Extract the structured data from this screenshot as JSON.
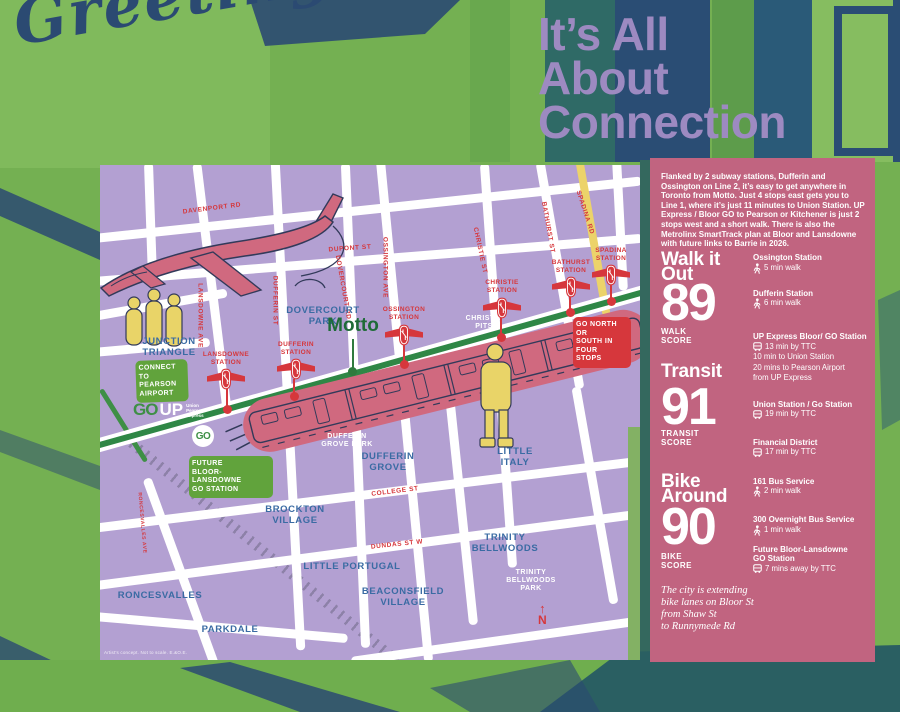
{
  "background": {
    "graffiti_text": "Greetings",
    "colors": {
      "bg_green": "#74b052",
      "navy": "#2b4a72",
      "teal": "#2f6a66",
      "map_purple": "#b3a0d2",
      "panel_pink": "#c16480",
      "station_red": "#d6373c",
      "line_green": "#2f8746",
      "badge_green": "#61a33c",
      "accent_yellow": "#ecd36a",
      "label_blue": "#3a6ba3",
      "title_purple": "#9d8ac1"
    }
  },
  "title": {
    "text": "It’s All\nAbout\nConnection"
  },
  "sidebar": {
    "intro": "Flanked by 2 subway stations, Dufferin and Ossington on Line 2, it’s easy to get anywhere in Toronto from Motto. Just 4 stops east gets you to Line 1, where it’s just 11 minutes to Union Station. UP Express / Bloor GO to Pearson or Kitchener is just 2 stops west and a short walk. There is also the Metrolinx SmartTrack plan at Bloor and Lansdowne with future links to Barrie in 2026.",
    "scores": [
      {
        "heading": "Walk it\nOut",
        "value": "89",
        "label": "WALK\nSCORE"
      },
      {
        "heading": "Transit",
        "value": "91",
        "label": "TRANSIT\nSCORE"
      },
      {
        "heading": "Bike\nAround",
        "value": "90",
        "label": "BIKE\nSCORE"
      }
    ],
    "note": "The city is extending\nbike lanes on Bloor St\nfrom Shaw St\nto Runnymede Rd",
    "destinations": [
      {
        "name": "Ossington Station",
        "icon": "walk",
        "lines": [
          "5 min walk"
        ]
      },
      {
        "name": "Dufferin Station",
        "icon": "walk",
        "lines": [
          "6 min walk"
        ]
      },
      {
        "name": "UP Express Bloor/ GO Station",
        "icon": "bus",
        "lines": [
          "13 min by TTC",
          "10 min to Union Station",
          "20 mins to Pearson Airport",
          "from UP Express"
        ]
      },
      {
        "name": "Union Station / Go Station",
        "icon": "bus",
        "lines": [
          "19 min by TTC"
        ]
      },
      {
        "name": "Financial District",
        "icon": "bus",
        "lines": [
          "17 min by TTC"
        ]
      },
      {
        "name": "161 Bus Service",
        "icon": "walk",
        "lines": [
          "2 min walk"
        ]
      },
      {
        "name": "300 Overnight Bus Service",
        "icon": "walk",
        "lines": [
          "1 min walk"
        ]
      },
      {
        "name": "Future Bloor-Lansdowne\nGO Station",
        "icon": "bus",
        "lines": [
          "7 mins away by TTC"
        ]
      }
    ]
  },
  "map": {
    "motto_label": "Motto",
    "attribution": "Artist's concept. Not to scale. E.&O.E.",
    "compass": "N",
    "go_up": {
      "go": "GO",
      "up": "UP",
      "sub": "Union\nPearson\nExpress"
    },
    "go_circle": "GO",
    "roads": [
      {
        "x": 50,
        "y": 55,
        "len": 115,
        "rot": 88
      },
      {
        "x": 112,
        "y": 122,
        "len": 250,
        "rot": 83
      },
      {
        "x": 81,
        "y": 407,
        "len": 200,
        "rot": 70
      },
      {
        "x": 188,
        "y": 240,
        "len": 490,
        "rot": 87
      },
      {
        "x": 255,
        "y": 240,
        "len": 485,
        "rot": 87.6
      },
      {
        "x": 304,
        "y": 245,
        "len": 505,
        "rot": 84.5
      },
      {
        "x": 360,
        "y": 330,
        "len": 260,
        "rot": 84
      },
      {
        "x": 398,
        "y": 200,
        "len": 405,
        "rot": 86
      },
      {
        "x": 460,
        "y": 110,
        "len": 230,
        "rot": 80
      },
      {
        "x": 495,
        "y": 330,
        "len": 220,
        "rot": 80
      },
      {
        "x": 520,
        "y": 60,
        "len": 130,
        "rot": 87
      },
      {
        "x": 260,
        "y": 45,
        "len": 565,
        "rot": -6
      },
      {
        "x": 260,
        "y": 95,
        "len": 565,
        "rot": -4.5
      },
      {
        "x": 260,
        "y": 330,
        "len": 565,
        "rot": -7
      },
      {
        "x": 262,
        "y": 385,
        "len": 565,
        "rot": -7.5
      },
      {
        "x": 400,
        "y": 475,
        "len": 300,
        "rot": -8
      },
      {
        "x": 120,
        "y": 462,
        "len": 255,
        "rot": 5
      },
      {
        "x": 55,
        "y": 140,
        "len": 145,
        "rot": -10
      },
      {
        "x": 50,
        "y": 182,
        "len": 120,
        "rot": -5
      },
      {
        "x": 492,
        "y": 70,
        "len": 165,
        "rot": 80,
        "th": 8,
        "color": "yellow"
      },
      {
        "x": 520,
        "y": 133,
        "len": 50,
        "rot": -16,
        "th": 6,
        "color": "yellow"
      },
      {
        "x": 23,
        "y": 260,
        "len": 85,
        "rot": 58,
        "th": 5,
        "color": "green"
      }
    ],
    "railway": {
      "x": 162,
      "y": 385,
      "len": 356,
      "rot": 39.4,
      "th": 10
    },
    "street_labels": [
      {
        "text": "DAVENPORT RD",
        "x": 112,
        "y": 40,
        "rot": -7
      },
      {
        "text": "DUPONT ST",
        "x": 250,
        "y": 80,
        "rot": -4
      },
      {
        "text": "LANSDOWNE AVE",
        "x": 100,
        "y": 147,
        "rot": 90
      },
      {
        "text": "DUFFERIN ST",
        "x": 175,
        "y": 132,
        "rot": 90
      },
      {
        "text": "DOVERCOURT RD",
        "x": 243,
        "y": 119,
        "rot": 80
      },
      {
        "text": "OSSINGTON AVE",
        "x": 285,
        "y": 99,
        "rot": 90
      },
      {
        "text": "CHRISTIE ST",
        "x": 380,
        "y": 82,
        "rot": 78
      },
      {
        "text": "BATHURST ST",
        "x": 448,
        "y": 59,
        "rot": 80
      },
      {
        "text": "SPADINA RD",
        "x": 485,
        "y": 44,
        "rot": 72
      },
      {
        "text": "COLLEGE ST",
        "x": 295,
        "y": 323,
        "rot": -7
      },
      {
        "text": "DUNDAS ST W",
        "x": 297,
        "y": 376,
        "rot": -6
      },
      {
        "text": "RONCESVALLES AVE",
        "x": 42,
        "y": 355,
        "rot": 85,
        "small": true
      }
    ],
    "neighbourhoods": [
      {
        "text": "JUNCTION\nTRIANGLE",
        "x": 69,
        "y": 172
      },
      {
        "text": "DOVERCOURT\nPARK",
        "x": 223,
        "y": 141
      },
      {
        "text": "DUFFERIN\nGROVE",
        "x": 288,
        "y": 287
      },
      {
        "text": "LITTLE\nITALY",
        "x": 415,
        "y": 282
      },
      {
        "text": "TRINITY\nBELLWOODS",
        "x": 405,
        "y": 368
      },
      {
        "text": "LITTLE PORTUGAL",
        "x": 252,
        "y": 397
      },
      {
        "text": "BEACONSFIELD\nVILLAGE",
        "x": 303,
        "y": 422
      },
      {
        "text": "BROCKTON\nVILLAGE",
        "x": 195,
        "y": 340
      },
      {
        "text": "RONCESVALLES",
        "x": 60,
        "y": 426
      },
      {
        "text": "PARKDALE",
        "x": 130,
        "y": 460
      }
    ],
    "parks": [
      {
        "text": "DUFFERIN\nGROVE PARK",
        "x": 247,
        "y": 268
      },
      {
        "text": "CHRISTIE\nPITS",
        "x": 384,
        "y": 150
      },
      {
        "text": "TRINITY\nBELLWOODS\nPARK",
        "x": 431,
        "y": 404
      }
    ],
    "stations": [
      {
        "name": "LANSDOWNE\nSTATION",
        "x": 126,
        "label_y": 186,
        "logo_y": 203,
        "dot_x": 127,
        "dot_y": 244
      },
      {
        "name": "DUFFERIN\nSTATION",
        "x": 196,
        "label_y": 176,
        "logo_y": 193,
        "dot_x": 194,
        "dot_y": 231
      },
      {
        "name": "OSSINGTON\nSTATION",
        "x": 304,
        "label_y": 141,
        "logo_y": 159,
        "dot_x": 304,
        "dot_y": 199
      },
      {
        "name": "CHRISTIE\nSTATION",
        "x": 402,
        "label_y": 114,
        "logo_y": 132,
        "dot_x": 401,
        "dot_y": 172
      },
      {
        "name": "BATHURST\nSTATION",
        "x": 471,
        "label_y": 94,
        "logo_y": 111,
        "dot_x": 470,
        "dot_y": 147
      },
      {
        "name": "SPADINA\nSTATION",
        "x": 511,
        "label_y": 82,
        "logo_y": 99,
        "dot_x": 511,
        "dot_y": 136
      }
    ],
    "badges": [
      {
        "lines": "CONNECT\nTO PEARSON\nAIRPORT",
        "x": 36,
        "y": 195,
        "w": 52,
        "variant": "green",
        "rot": -2
      },
      {
        "lines": "FUTURE\nBLOOR-LANSDOWNE\nGO STATION",
        "x": 89,
        "y": 291,
        "w": 84,
        "variant": "green",
        "rot": 0
      },
      {
        "lines": "GO NORTH OR\nSOUTH IN\nFOUR\nSTOPS",
        "x": 473,
        "y": 152,
        "w": 58,
        "variant": "red",
        "rot": 0
      }
    ]
  }
}
